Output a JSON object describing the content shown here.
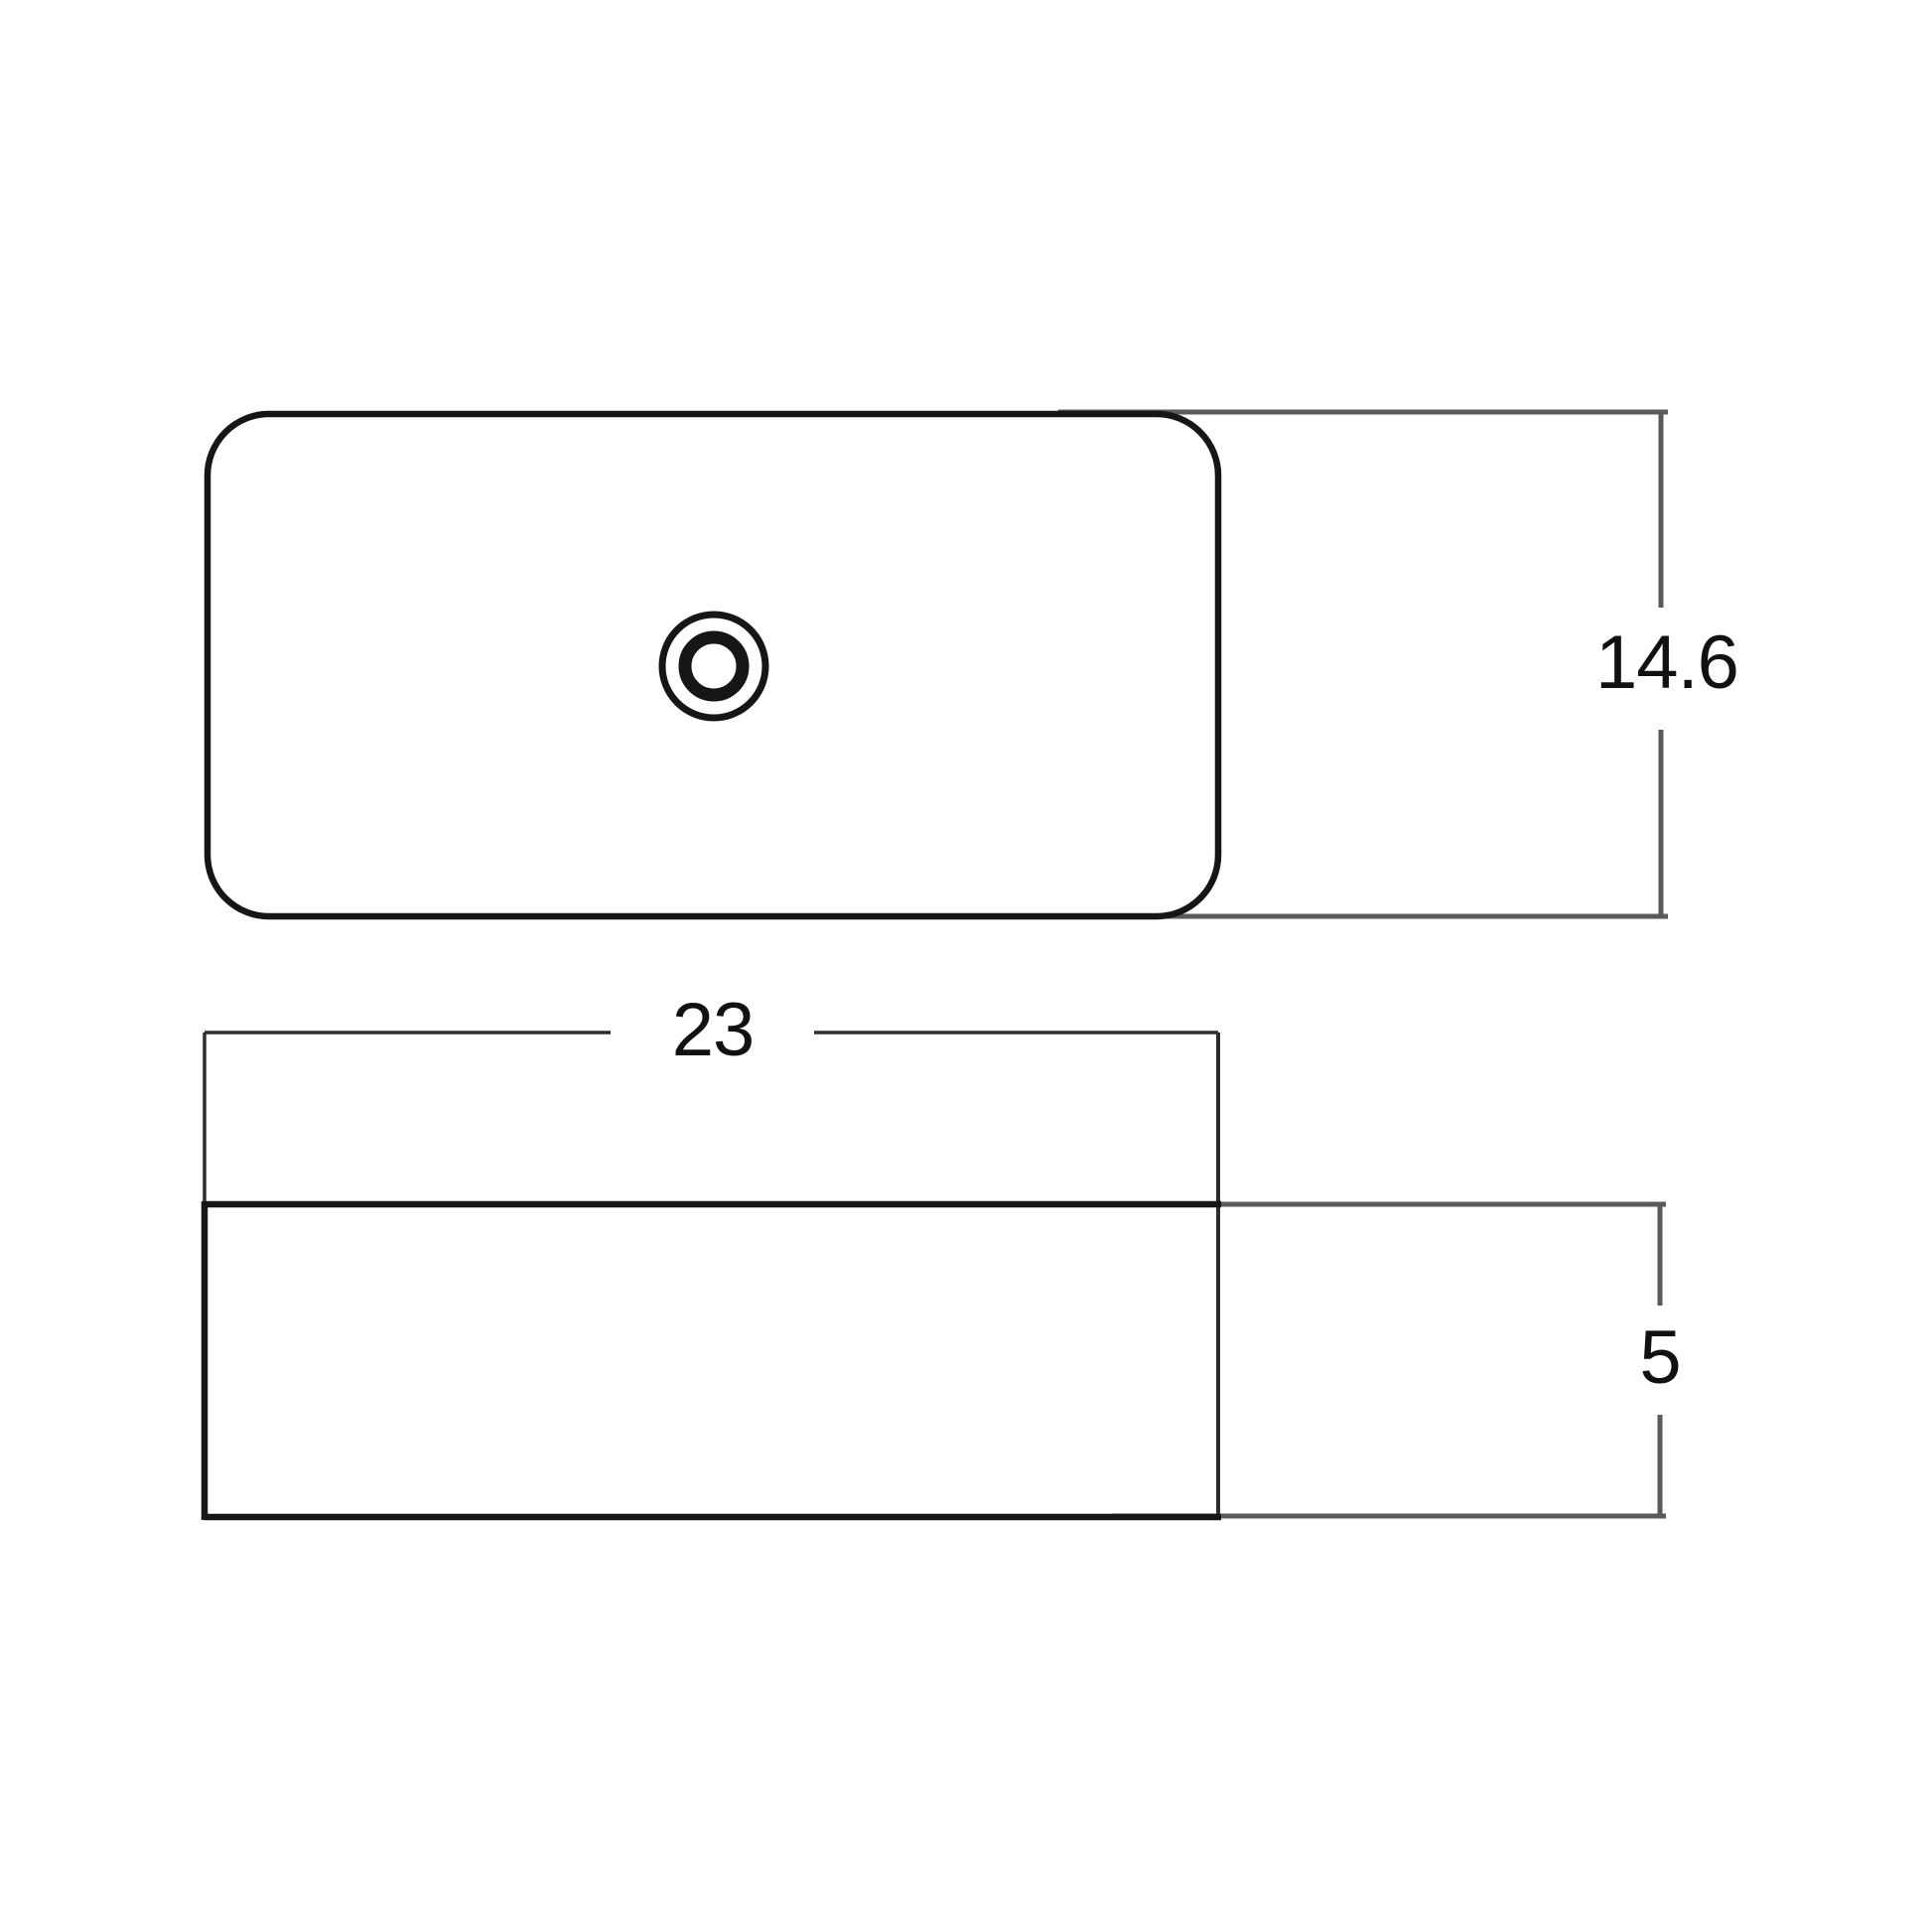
{
  "diagram": {
    "type": "technical-dimension-drawing",
    "views": {
      "top_view": {
        "name": "sink top view",
        "features": [
          "rounded-rectangle rim",
          "center drain hole"
        ]
      },
      "front_view": {
        "name": "sink front view"
      }
    },
    "dimensions": {
      "width": {
        "label": "23"
      },
      "depth": {
        "label": "14.6"
      },
      "height": {
        "label": "5"
      }
    },
    "colors": {
      "background": "#ffffff",
      "line_bold": "#161616",
      "line_thin": "#2d2d2d",
      "line_dim": "#5a5a5a",
      "text": "#111111"
    }
  }
}
